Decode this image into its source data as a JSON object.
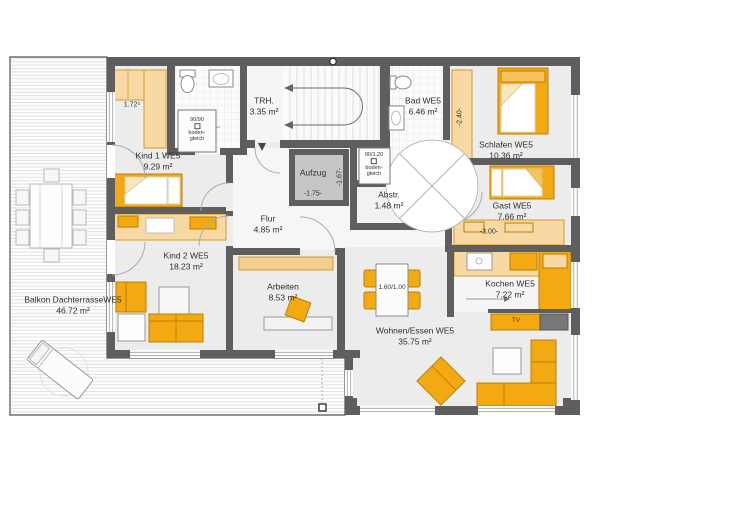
{
  "rooms": {
    "balkon": {
      "name": "Balkon DachterrasseWE5",
      "area": "46.72 m²"
    },
    "kind1": {
      "name": "Kind 1 WE5",
      "area": "9.29 m²"
    },
    "kind2": {
      "name": "Kind 2 WE5",
      "area": "18.23 m²"
    },
    "trh": {
      "name": "TRH.",
      "area": "3.35 m²"
    },
    "bad": {
      "name": "Bad WE5",
      "area": "6.46 m²"
    },
    "schlafen": {
      "name": "Schlafen WE5",
      "area": "10.36 m²"
    },
    "gast": {
      "name": "Gast WE5",
      "area": "7.66 m²"
    },
    "kochen": {
      "name": "Kochen WE5",
      "area": "7.22 m²"
    },
    "wohnen": {
      "name": "Wohnen/Essen WE5",
      "area": "35.75 m²"
    },
    "arbeiten": {
      "name": "Arbeiten",
      "area": "8.53 m²"
    },
    "flur": {
      "name": "Flur",
      "area": "4.85 m²"
    },
    "abstr": {
      "name": "Abstr.",
      "area": "1.48 m²"
    },
    "aufzug": {
      "name": "Aufzug"
    }
  },
  "annotations": {
    "closet_kind1_dim": "1.72⁵",
    "wardrobe_schlafen_dim": "-2.40-",
    "wardrobe_gast_dim": "-3.00-",
    "aufzug_width_dim": "-1.75-",
    "aufzug_depth_dim": "-1.67-",
    "dining_table_dim": "1.60/1.00",
    "tv_label": "TV",
    "shower_kind": {
      "size": "90/90",
      "note1": "boden-",
      "note2": "gleich"
    },
    "shower_bad": {
      "size": "90/1.20",
      "note1": "boden-",
      "note2": "gleich"
    }
  },
  "colors": {
    "wall": "#5E5E5E",
    "furniture_accent": "#F2A912",
    "furniture_light": "#F8D9A4",
    "floor": "#ECECEC",
    "elevator": "#C6C6C6"
  }
}
